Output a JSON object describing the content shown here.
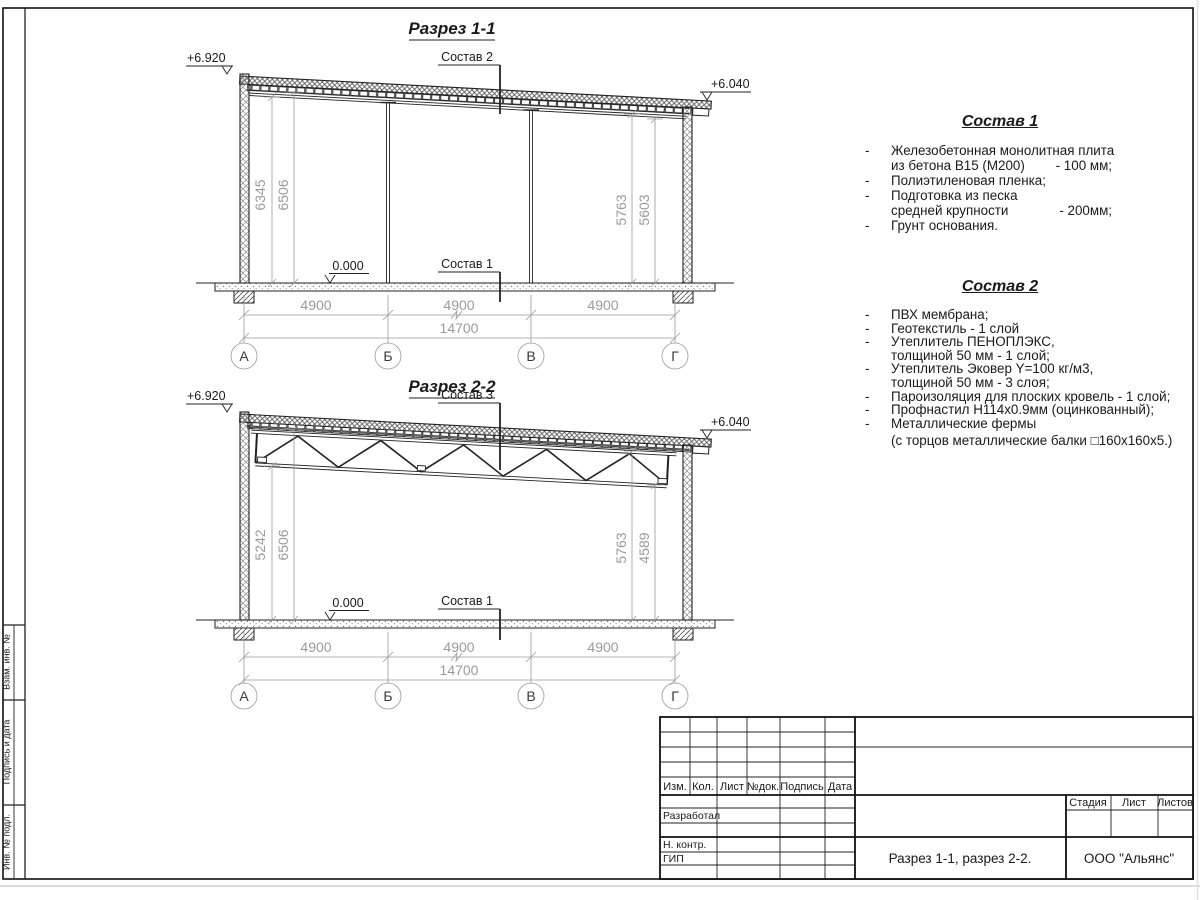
{
  "frame": {
    "side_labels": [
      "Взам. инв. №",
      "Подпись и дата",
      "Инв. № подл."
    ]
  },
  "section1": {
    "title": "Разрез 1-1",
    "elev_left": "+6.920",
    "elev_right": "+6.040",
    "zero": "0.000",
    "roof_label": "Состав 2",
    "floor_label": "Состав 1",
    "dim_left_outer": "6345",
    "dim_left_inner": "6506",
    "dim_right_inner": "5763",
    "dim_right_outer": "5603",
    "span_dims": [
      "4900",
      "4900",
      "4900"
    ],
    "total_dim": "14700",
    "axes": [
      "А",
      "Б",
      "В",
      "Г"
    ]
  },
  "section2": {
    "title": "Разрез 2-2",
    "elev_left": "+6.920",
    "elev_right": "+6.040",
    "zero": "0.000",
    "roof_label": "Состав 3",
    "floor_label": "Состав 1",
    "dim_left_outer": "5242",
    "dim_left_inner": "6506",
    "dim_right_inner": "5763",
    "dim_right_outer": "4589",
    "span_dims": [
      "4900",
      "4900",
      "4900"
    ],
    "total_dim": "14700",
    "axes": [
      "А",
      "Б",
      "В",
      "Г"
    ]
  },
  "notes1": {
    "title": "Состав 1",
    "rows": [
      {
        "b": "-",
        "t": "Железобетонная  монолитная плита",
        "v": ""
      },
      {
        "b": "",
        "t": "из бетона В15 (М200)",
        "v": "- 100 мм;"
      },
      {
        "b": "-",
        "t": "Полиэтиленовая пленка;",
        "v": ""
      },
      {
        "b": "-",
        "t": "Подготовка из песка",
        "v": ""
      },
      {
        "b": "",
        "t": "средней крупности",
        "v": "- 200мм;"
      },
      {
        "b": "-",
        "t": "Грунт основания.",
        "v": ""
      }
    ]
  },
  "notes2": {
    "title": "Состав 2",
    "rows": [
      {
        "b": "-",
        "t": "ПВХ мембрана;",
        "v": ""
      },
      {
        "b": "-",
        "t": "Геотекстиль - 1 слой",
        "v": ""
      },
      {
        "b": "-",
        "t": "Утеплитель ПЕНОПЛЭКС,",
        "v": ""
      },
      {
        "b": "",
        "t": "толщиной 50 мм - 1 слой;",
        "v": ""
      },
      {
        "b": "-",
        "t": "Утеплитель Эковер Y=100 кг/м3,",
        "v": ""
      },
      {
        "b": "",
        "t": "толщиной 50 мм - 3 слоя;",
        "v": ""
      },
      {
        "b": "-",
        "t": "Пароизоляция для плоских кровель - 1 слой;",
        "v": ""
      },
      {
        "b": "-",
        "t": "Профнастил Н114х0.9мм (оцинкованный);",
        "v": ""
      },
      {
        "b": "-",
        "t": "Металлические фермы",
        "v": ""
      },
      {
        "b": "",
        "t": "(с торцов металлические балки □160х160х5.)",
        "v": ""
      }
    ]
  },
  "titleblock": {
    "rev_headers": [
      "Изм.",
      "Кол.",
      "Лист",
      "№док.",
      "Подпись",
      "Дата"
    ],
    "role_rows": [
      "Разработал",
      "Н. контр.",
      "ГИП"
    ],
    "stage_headers": [
      "Стадия",
      "Лист",
      "Листов"
    ],
    "doc_title": "Разрез 1-1, разрез 2-2.",
    "company": "ООО \"Альянс\""
  }
}
